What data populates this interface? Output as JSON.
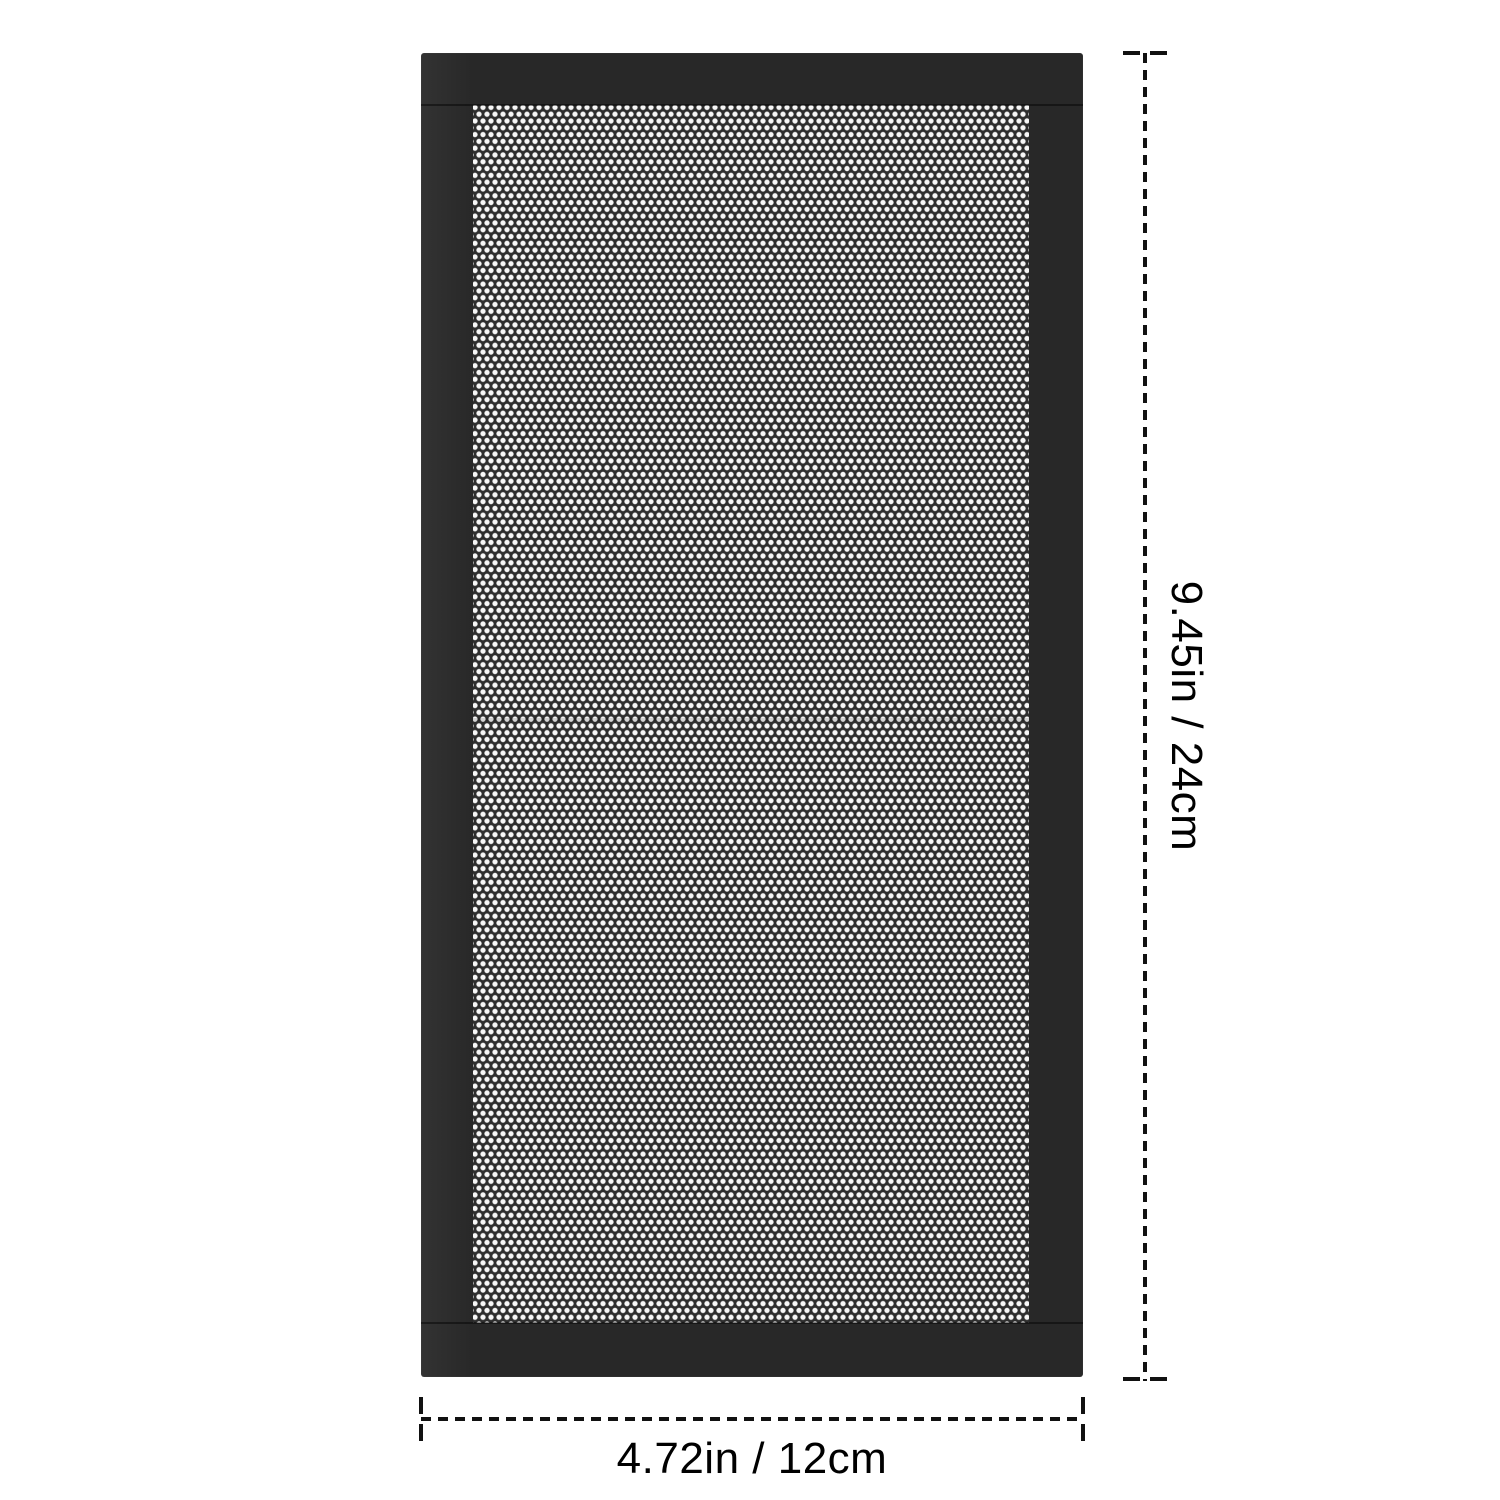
{
  "product": {
    "name": "mesh-dust-filter-panel"
  },
  "dimensions": {
    "height_label": "9.45in / 24cm",
    "width_label": "4.72in / 12cm"
  },
  "colors": {
    "background": "#ffffff",
    "frame": "#282828",
    "mesh-bg": "#2e2e2e",
    "mesh-dot": "#f7f7f7",
    "dimension-line": "#111111",
    "label-text": "#000000"
  }
}
